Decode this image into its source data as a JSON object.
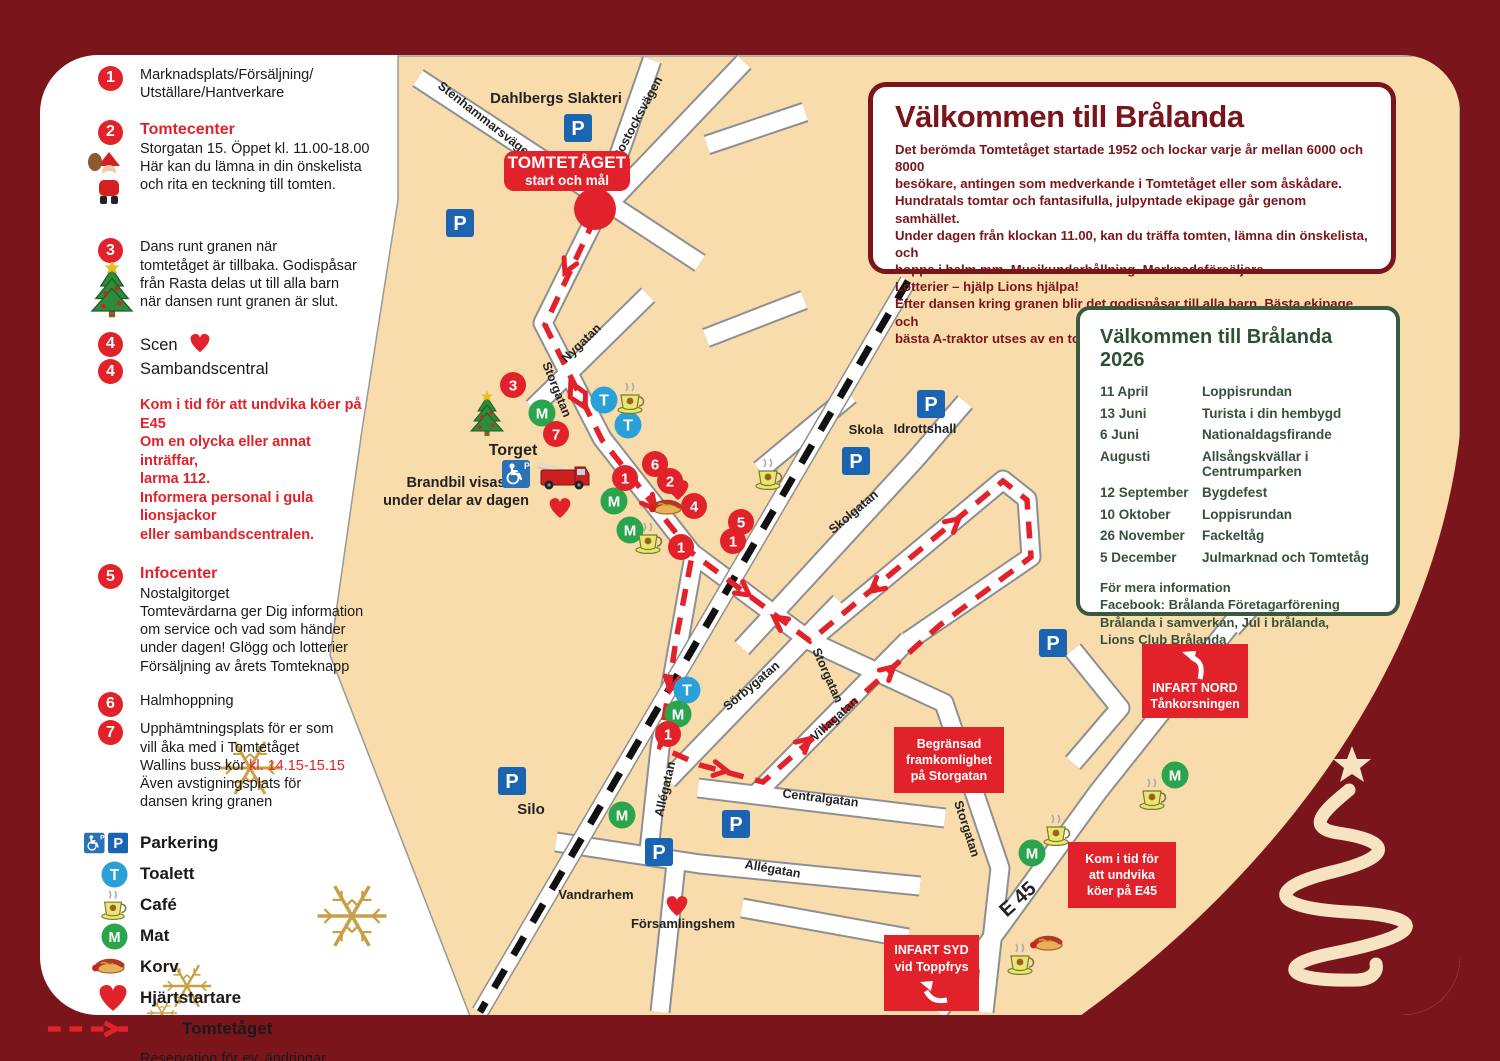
{
  "colors": {
    "frame": "#7a161b",
    "land": "#f9dcab",
    "route_red": "#e2222a",
    "parking_blue": "#1a64b2",
    "toilet_blue": "#29a1d8",
    "food_green": "#2ba44e",
    "calendar_green": "#3a5a40",
    "gold": "#c9a045"
  },
  "legend": {
    "items": [
      {
        "num": "1",
        "text": "Marknadsplats/Försäljning/\nUtställare/Hantverkare"
      },
      {
        "num": "2",
        "title": "Tomtecenter",
        "text": "Storgatan 15. Öppet kl. 11.00-18.00\nHär kan du lämna in din önskelista\noch rita en teckning till tomten."
      },
      {
        "num": "3",
        "text": "Dans runt granen när\ntomtetåget är tillbaka. Godispåsar\nfrån Rasta delas ut till alla barn\nnär dansen runt granen är slut."
      },
      {
        "num": "4",
        "text": "Scen"
      },
      {
        "num": "4",
        "text": "Sambandscentral"
      },
      {
        "num": "5",
        "title": "Infocenter",
        "text": "Nostalgitorget\nTomtevärdarna ger Dig information\nom service och vad som händer\nunder dagen!  Glögg och lotterier\nFörsäljning av årets Tomteknapp"
      },
      {
        "num": "6",
        "text": "Halmhoppning"
      },
      {
        "num": "7",
        "text_before": "Upphämtningsplats för er som\nvill åka med  i Tomtetåget\nWallins buss kör ",
        "highlight": "kl. 14.15-15.15",
        "text_after": "Även avstigningsplats för\ndansen kring granen"
      }
    ],
    "warning": "Kom i tid för att undvika köer på E45\nOm en olycka eller annat inträffar,\nlarma 112.\nInformera personal i gula lionsjackor\neller sambandscentralen.",
    "symbols": {
      "parking": "Parkering",
      "toilet": "Toalett",
      "cafe": "Café",
      "food": "Mat",
      "korv": "Korv",
      "heart": "Hjärtstartare",
      "route": "Tomtetåget"
    },
    "note": "Reservation för ev. ändringar"
  },
  "welcome": {
    "title": "Välkommen till Brålanda",
    "body": "Det berömda Tomtetåget startade 1952 och lockar varje år mellan 6000 och 8000\nbesökare, antingen som medverkande i Tomtetåget eller som åskådare.\nHundratals tomtar och fantasifulla, julpyntade ekipage går genom samhället.\nUnder dagen från klockan 11.00, kan du träffa tomten, lämna din önskelista, och\nhoppa i halm mm. Musikunderhållning. Marknadsförsäljare.\nLotterier – hjälp Lions hjälpa!\nEfter dansen kring granen blir det godispåsar till alla barn. Bästa ekipage och\nbästa A-traktor utses av en tomtejury."
  },
  "calendar": {
    "title": "Välkommen till Brålanda 2026",
    "rows": [
      {
        "date": "11 April",
        "event": "Loppisrundan"
      },
      {
        "date": "13 Juni",
        "event": "Turista i din hembygd"
      },
      {
        "date": "6 Juni",
        "event": "Nationaldagsfirande"
      },
      {
        "date": "Augusti",
        "event": "Allsångskvällar i Centrumparken"
      },
      {
        "date": "12 September",
        "event": "Bygdefest"
      },
      {
        "date": "10 Oktober",
        "event": "Loppisrundan"
      },
      {
        "date": "26 November",
        "event": "Fackeltåg"
      },
      {
        "date": "5 December",
        "event": "Julmarknad och Tomtetåg"
      }
    ],
    "footer": "För mera information\nFacebook: Brålanda Företagarförening\nBrålanda i samverkan, Jul i brålanda,\nLions Club Brålanda"
  },
  "signs": {
    "start": {
      "line1": "TOMTETÅGET",
      "line2": "start och mål"
    },
    "infart_nord": {
      "line1": "INFART NORD",
      "line2": "Tånkorsningen"
    },
    "infart_syd": {
      "line1": "INFART SYD",
      "line2": "vid Toppfrys"
    },
    "begransad": "Begränsad\nframkomlighet\npå Storgatan",
    "kom_i_tid": "Kom i tid för\natt undvika\nköer på E45"
  },
  "map": {
    "street_labels": [
      {
        "t": "Dahlbergs Slakteri",
        "x": 556,
        "y": 103,
        "r": 0,
        "s": 15
      },
      {
        "t": "Stenhammarsvägen",
        "x": 484,
        "y": 124,
        "r": 38,
        "s": 12.5
      },
      {
        "t": "Rostocksvägen",
        "x": 641,
        "y": 120,
        "r": -62,
        "s": 12.5
      },
      {
        "t": "Nygatan",
        "x": 584,
        "y": 346,
        "r": -44,
        "s": 12.5
      },
      {
        "t": "Storgatan",
        "x": 553,
        "y": 391,
        "r": 68,
        "s": 12.5
      },
      {
        "t": "Torget",
        "x": 513,
        "y": 455,
        "r": 0,
        "s": 16
      },
      {
        "t": "Brandbil visas\nunder delar av dagen",
        "x": 456,
        "y": 487,
        "r": 0,
        "s": 14.5
      },
      {
        "t": "Skola",
        "x": 866,
        "y": 434,
        "r": 0,
        "s": 13
      },
      {
        "t": "Idrottshall",
        "x": 925,
        "y": 433,
        "r": 0,
        "s": 13
      },
      {
        "t": "Skolgatan",
        "x": 856,
        "y": 515,
        "r": -40,
        "s": 12.5
      },
      {
        "t": "Sörbygatan",
        "x": 754,
        "y": 689,
        "r": -40,
        "s": 12.5
      },
      {
        "t": "Storgatan",
        "x": 824,
        "y": 677,
        "r": 66,
        "s": 12.5
      },
      {
        "t": "Villagatan",
        "x": 837,
        "y": 722,
        "r": -42,
        "s": 12.5
      },
      {
        "t": "Centralgatan",
        "x": 820,
        "y": 802,
        "r": 7,
        "s": 12.5
      },
      {
        "t": "Allégatan",
        "x": 669,
        "y": 790,
        "r": -77,
        "s": 12.5
      },
      {
        "t": "Allégatan",
        "x": 772,
        "y": 873,
        "r": 10,
        "s": 12.5
      },
      {
        "t": "Storgatan",
        "x": 963,
        "y": 830,
        "r": 72,
        "s": 12.5
      },
      {
        "t": "E 45",
        "x": 1022,
        "y": 904,
        "r": -42,
        "s": 20,
        "bold": true
      },
      {
        "t": "Silo",
        "x": 531,
        "y": 814,
        "r": 0,
        "s": 15
      },
      {
        "t": "Vandrarhem",
        "x": 596,
        "y": 899,
        "r": 0,
        "s": 13
      },
      {
        "t": "Församlingshem",
        "x": 683,
        "y": 928,
        "r": 0,
        "s": 13
      }
    ],
    "markers": [
      {
        "k": "p",
        "x": 578,
        "y": 128
      },
      {
        "k": "p",
        "x": 460,
        "y": 223
      },
      {
        "k": "p",
        "x": 931,
        "y": 404
      },
      {
        "k": "p",
        "x": 856,
        "y": 461
      },
      {
        "k": "p",
        "x": 1053,
        "y": 643
      },
      {
        "k": "p",
        "x": 512,
        "y": 781
      },
      {
        "k": "p",
        "x": 736,
        "y": 824
      },
      {
        "k": "p",
        "x": 659,
        "y": 852
      },
      {
        "k": "t",
        "x": 604,
        "y": 400
      },
      {
        "k": "t",
        "x": 628,
        "y": 425
      },
      {
        "k": "t",
        "x": 687,
        "y": 690
      },
      {
        "k": "m",
        "x": 542,
        "y": 413
      },
      {
        "k": "m",
        "x": 614,
        "y": 501
      },
      {
        "k": "m",
        "x": 630,
        "y": 530
      },
      {
        "k": "m",
        "x": 678,
        "y": 714
      },
      {
        "k": "m",
        "x": 622,
        "y": 815
      },
      {
        "k": "m",
        "x": 1032,
        "y": 853
      },
      {
        "k": "m",
        "x": 1175,
        "y": 775
      },
      {
        "k": "cafe",
        "x": 630,
        "y": 401
      },
      {
        "k": "cafe",
        "x": 648,
        "y": 541
      },
      {
        "k": "cafe",
        "x": 768,
        "y": 477
      },
      {
        "k": "cafe",
        "x": 1056,
        "y": 833
      },
      {
        "k": "cafe",
        "x": 1152,
        "y": 797
      },
      {
        "k": "cafe",
        "x": 1020,
        "y": 962
      },
      {
        "k": "korv",
        "x": 667,
        "y": 508
      },
      {
        "k": "korv",
        "x": 1048,
        "y": 944
      },
      {
        "k": "heart",
        "x": 560,
        "y": 505
      },
      {
        "k": "heart",
        "x": 678,
        "y": 487
      },
      {
        "k": "heart",
        "x": 677,
        "y": 903
      },
      {
        "k": "num",
        "n": "3",
        "x": 513,
        "y": 385
      },
      {
        "k": "num",
        "n": "7",
        "x": 556,
        "y": 434
      },
      {
        "k": "num",
        "n": "6",
        "x": 655,
        "y": 464
      },
      {
        "k": "num",
        "n": "2",
        "x": 670,
        "y": 481
      },
      {
        "k": "num",
        "n": "1",
        "x": 625,
        "y": 478
      },
      {
        "k": "num",
        "n": "4",
        "x": 694,
        "y": 506
      },
      {
        "k": "num",
        "n": "5",
        "x": 741,
        "y": 522
      },
      {
        "k": "num",
        "n": "1",
        "x": 733,
        "y": 541
      },
      {
        "k": "num",
        "n": "1",
        "x": 681,
        "y": 547
      },
      {
        "k": "num",
        "n": "1",
        "x": 668,
        "y": 734
      },
      {
        "k": "start",
        "x": 595,
        "y": 209
      },
      {
        "k": "tree",
        "x": 487,
        "y": 415
      },
      {
        "k": "truck",
        "x": 561,
        "y": 476
      },
      {
        "k": "hcp",
        "x": 516,
        "y": 474
      },
      {
        "k": "flake",
        "x": 250,
        "y": 768,
        "s": 1.0
      },
      {
        "k": "flake",
        "x": 352,
        "y": 916,
        "s": 1.15
      },
      {
        "k": "flake",
        "x": 187,
        "y": 986,
        "s": 0.8
      },
      {
        "k": "flake",
        "x": 162,
        "y": 1013,
        "s": 0.5
      }
    ]
  }
}
